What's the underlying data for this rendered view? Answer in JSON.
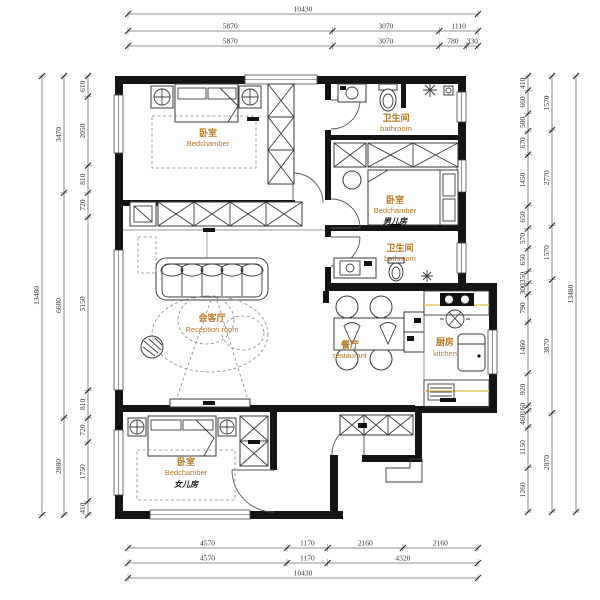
{
  "drawing": {
    "type": "apartment-floor-plan"
  },
  "colors": {
    "wall": "#141414",
    "drawing_line": "#3a3a3a",
    "dimension_text": "#333333",
    "room_label_accent": "#b5771f",
    "sub_label": "#1c1c1c",
    "kitchen_highlight": "#ecd06d",
    "background": "#ffffff"
  },
  "rooms": {
    "master": {
      "cn": "卧室",
      "en": "Bedchamber"
    },
    "bath_top": {
      "cn": "卫生间",
      "en": "bathroom"
    },
    "boy": {
      "cn": "卧室",
      "en": "Bedchamber",
      "sub": "男儿房"
    },
    "bath_mid": {
      "cn": "卫生间",
      "en": "bathroom"
    },
    "reception": {
      "cn": "会客厅",
      "en": "Reception room"
    },
    "dining": {
      "cn": "餐厅",
      "en": "restaurant"
    },
    "kitchen": {
      "cn": "厨房",
      "en": "kitchen"
    },
    "girl": {
      "cn": "卧室",
      "en": "Bedchamber",
      "sub": "女儿房"
    }
  },
  "dimensions": {
    "top": {
      "overall": "10430",
      "row2": [
        "5870",
        "3070",
        "1110"
      ],
      "row3": [
        "5870",
        "3070",
        "780",
        "330"
      ]
    },
    "bottom": {
      "row1": [
        "4570",
        "1170",
        "2160",
        "2160"
      ],
      "row2": [
        "4570",
        "1170",
        "4320"
      ],
      "overall": "10430"
    },
    "left": {
      "overall": "13480",
      "groups": [
        "3470",
        "6680",
        "2880"
      ],
      "segments": [
        "610",
        "2050",
        "810",
        "720",
        "5150",
        "810",
        "720",
        "1750",
        "410"
      ]
    },
    "right": {
      "overall": "13480",
      "groups": [
        "1570",
        "2770",
        "1570",
        "3870",
        "2870"
      ],
      "segments": [
        "410",
        "660",
        "500",
        "670",
        "1450",
        "650",
        "570",
        "650",
        "350",
        "300",
        "790",
        "1460",
        "920",
        "160",
        "460",
        "1150",
        "1260"
      ]
    }
  }
}
